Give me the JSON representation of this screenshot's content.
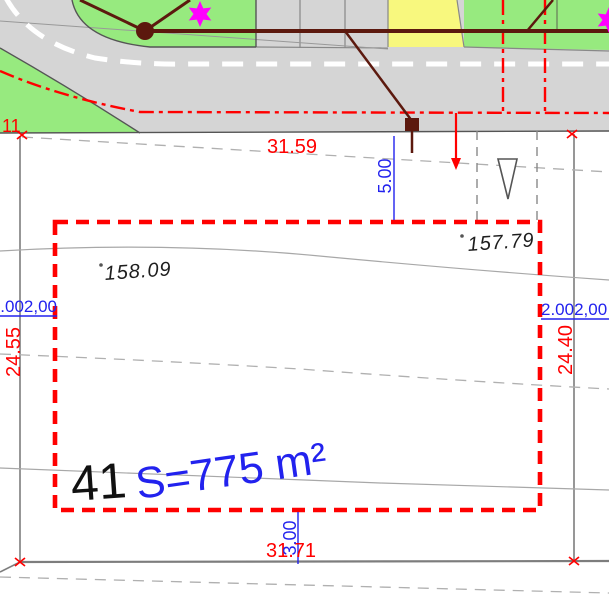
{
  "plan": {
    "boundary_point_label": "11",
    "parcel_number": "41",
    "parcel_area": "S=775 m²",
    "dim_top": "31.59",
    "dim_bottom": "31.71",
    "dim_left": "24.55",
    "dim_right": "24.40",
    "offset_top": "5.00",
    "offset_bottom": "3.00",
    "grid_label_left": "2.002,00",
    "grid_label_right": "2.002,00",
    "spot_elevation_inner": "158.09",
    "spot_elevation_outer": "157.79"
  },
  "colors": {
    "road_fill": "#d5d5d5",
    "green_fill": "#97ea7f",
    "yellow_fill": "#f8f87e",
    "outline_red": "#ff0000",
    "dim_blue": "#2222ee",
    "utility_maroon": "#5c190e",
    "star_magenta": "#ff00ff"
  },
  "symbols": {
    "star": "six-pointed-star-icon",
    "triangle": "survey-triangle-marker",
    "node": "utility-node-marker",
    "cross": "boundary-point-cross"
  }
}
